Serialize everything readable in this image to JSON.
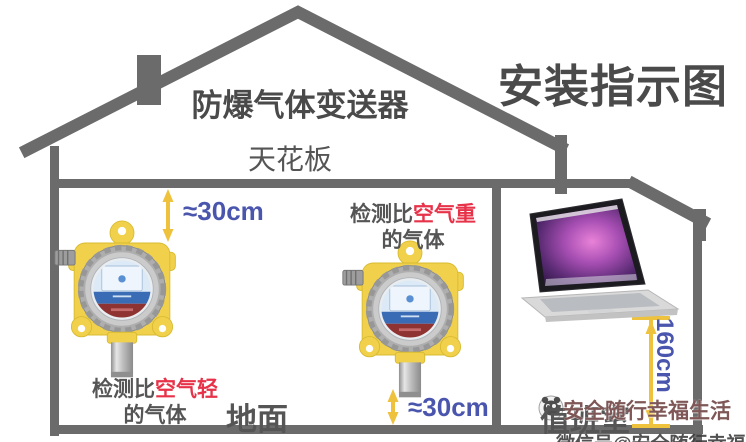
{
  "title": "安装指示图",
  "header": {
    "device_title": "防爆气体变送器",
    "ceiling_label": "天花板"
  },
  "annotations": {
    "top_clearance": "≈30cm",
    "bottom_clearance": "≈30cm",
    "mount_height": "160cm",
    "heavier": {
      "prefix": "检测比",
      "highlight": "空气重",
      "line2": "的气体"
    },
    "lighter": {
      "prefix": "检测比",
      "highlight": "空气轻",
      "line2": "的气体"
    },
    "ground_label": "地面",
    "duty_room_label": "值班室"
  },
  "devices": {
    "left_detector": "explosion-proof-gas-detector",
    "middle_detector": "explosion-proof-gas-detector",
    "monitor": "monitoring-laptop"
  },
  "watermark": {
    "logo": "mascot-logo-icon",
    "brand": "安全随行幸福生活",
    "bottom_line": "微信号@安全随行幸福生活"
  },
  "colors": {
    "structure": "#6b6b6b",
    "heading": "#4a4a4a",
    "text": "#555555",
    "blue": "#4a55ad",
    "red": "#e73349",
    "arrow": "#eec23d",
    "detector-body": "#f1d14b",
    "detector-edge": "#d8bb32",
    "ring-outer": "#aeaeae",
    "ring-inner": "#cbcbcb",
    "screen-blue": "#3a6cb5",
    "band-red": "#8e3232",
    "laptop-base": "#d9d9d9"
  }
}
